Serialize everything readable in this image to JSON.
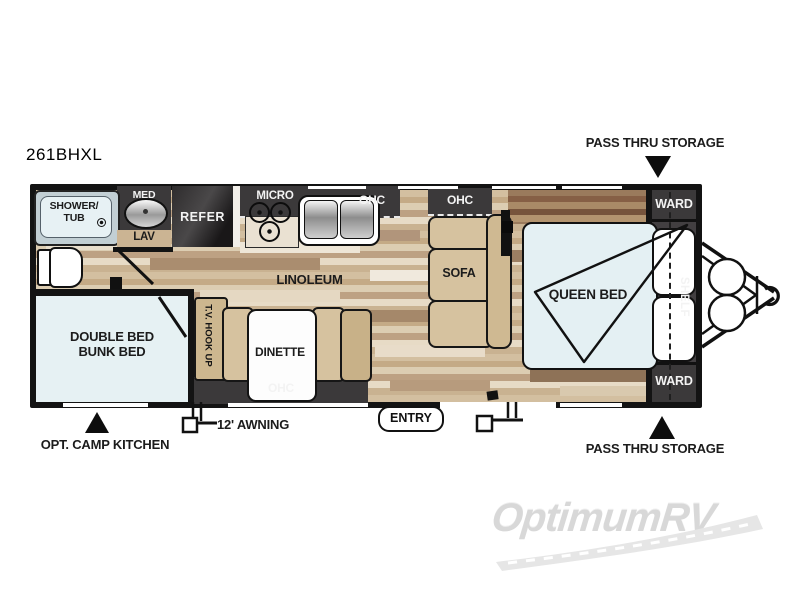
{
  "title": "261BHXL",
  "exterior": {
    "pass_thru_storage_top": "PASS THRU STORAGE",
    "pass_thru_storage_bottom": "PASS THRU STORAGE",
    "opt_camp_kitchen": "OPT. CAMP KITCHEN",
    "awning": "12' AWNING",
    "entry": "ENTRY"
  },
  "interior": {
    "shower_line1": "SHOWER/",
    "shower_line2": "TUB",
    "med": "MED",
    "lav": "LAV",
    "refer": "REFER",
    "micro": "MICRO",
    "ohc_kitchen": "OHC",
    "ohc_sofa": "OHC",
    "ohc_dinette": "OHC",
    "linoleum": "LINOLEUM",
    "sofa": "SOFA",
    "dinette": "DINETTE",
    "tv_hookup": "T.V. HOOK UP",
    "bunk_line1": "DOUBLE BED",
    "bunk_line2": "BUNK BED",
    "queen_bed": "QUEEN BED",
    "shelf": "SHELF",
    "ward_front_top": "WARD",
    "ward_front_bottom": "WARD"
  },
  "watermark": "OptimumRV",
  "colors": {
    "wall": "#131313",
    "cabinet_dark": "#3b393a",
    "furniture_tan": "#d6c29f",
    "mattress_blue": "#e4f0f3",
    "floor_base": "#c9b291",
    "watermark_gray": "#d8d8d8"
  }
}
